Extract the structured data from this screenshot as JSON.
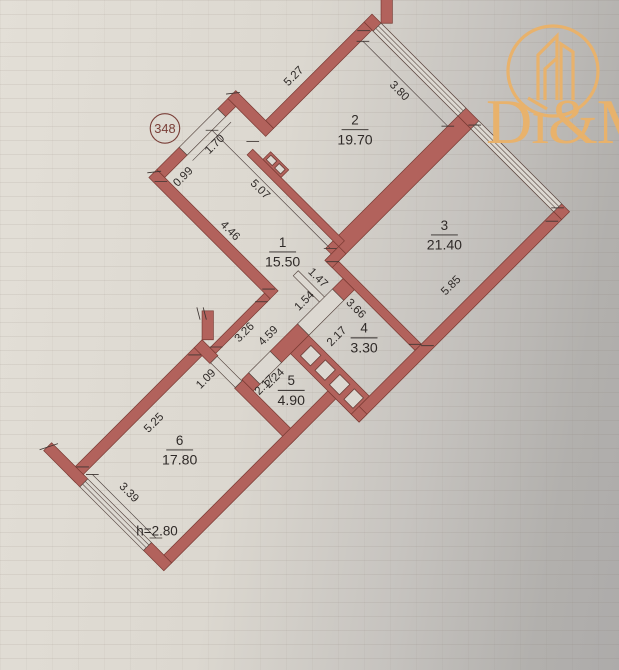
{
  "plan": {
    "badge": "348",
    "height_note": "h=2.80",
    "rooms": [
      {
        "number": "1",
        "area": "15.50"
      },
      {
        "number": "2",
        "area": "19.70"
      },
      {
        "number": "3",
        "area": "21.40"
      },
      {
        "number": "4",
        "area": "3.30"
      },
      {
        "number": "5",
        "area": "4.90"
      },
      {
        "number": "6",
        "area": "17.80"
      }
    ],
    "dimensions": {
      "room2_window": "3.80",
      "room2_side": "5.27",
      "hall_top": "5.07",
      "hall_side": "4.46",
      "entry_door": "1.70",
      "entry_jog": "0.99",
      "neck_side": "3.26",
      "room3_side": "5.85",
      "room3_bottom": "3.66",
      "opening_room3": "1.47",
      "room4_door": "1.54",
      "room4_depth": "2.17",
      "shaft_run": "4.59",
      "room5_width": "2.24",
      "room5_depth": "2.17",
      "room6_door": "1.09",
      "room6_side": "5.25",
      "room6_window": "3.39"
    },
    "colors": {
      "wall": "#b2625c",
      "wall_outline": "#7a3a33",
      "paper": "#dcd8d1",
      "ink": "#2f2a28",
      "logo_gold": "#e8b26c"
    }
  },
  "logo": {
    "text": "Dı&M"
  }
}
